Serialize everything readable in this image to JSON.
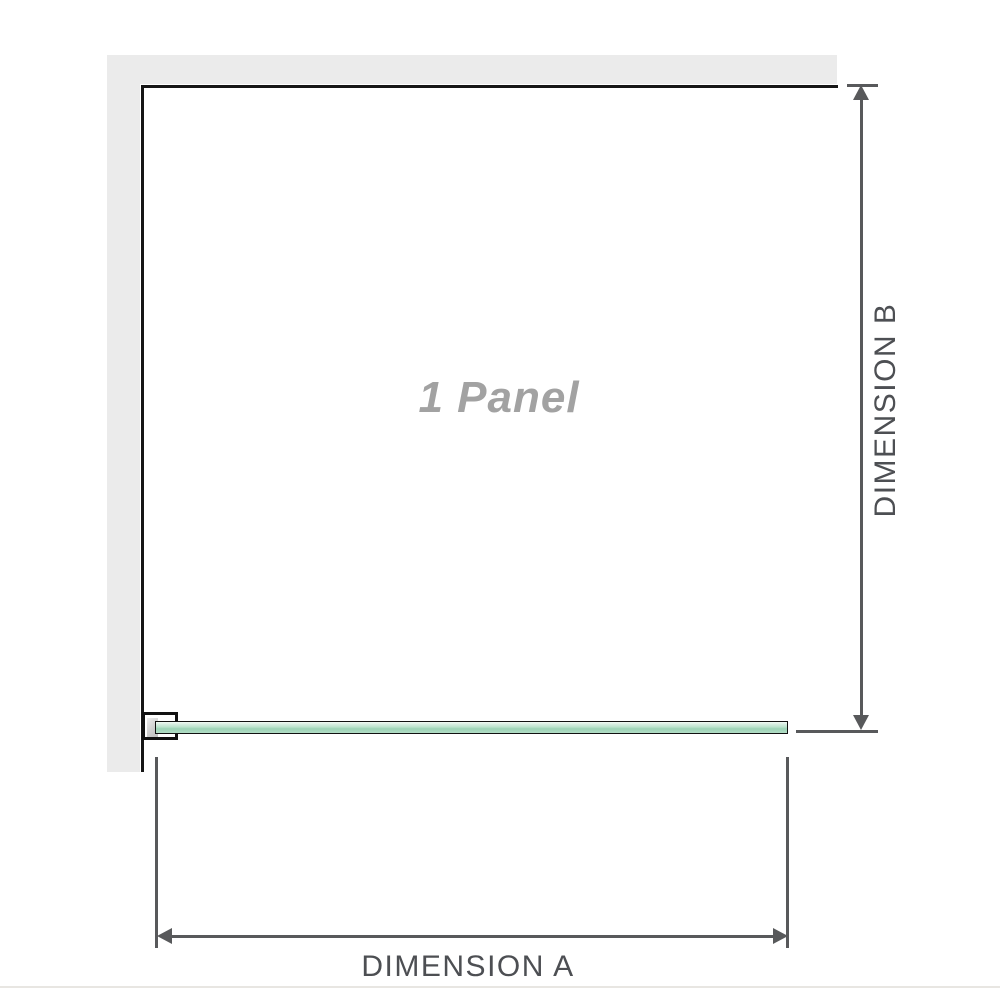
{
  "diagram": {
    "panel_label": "1 Panel",
    "dimension_a_label": "DIMENSION A",
    "dimension_b_label": "DIMENSION B"
  },
  "colors": {
    "wall": "#ebebeb",
    "outline": "#161616",
    "dimension_line": "#58595b",
    "dimension_text": "#4d4f53",
    "panel_label_text": "#a2a2a2",
    "glass_green_light": "#d4ecdf",
    "glass_green_dark": "#9cd3b6"
  }
}
